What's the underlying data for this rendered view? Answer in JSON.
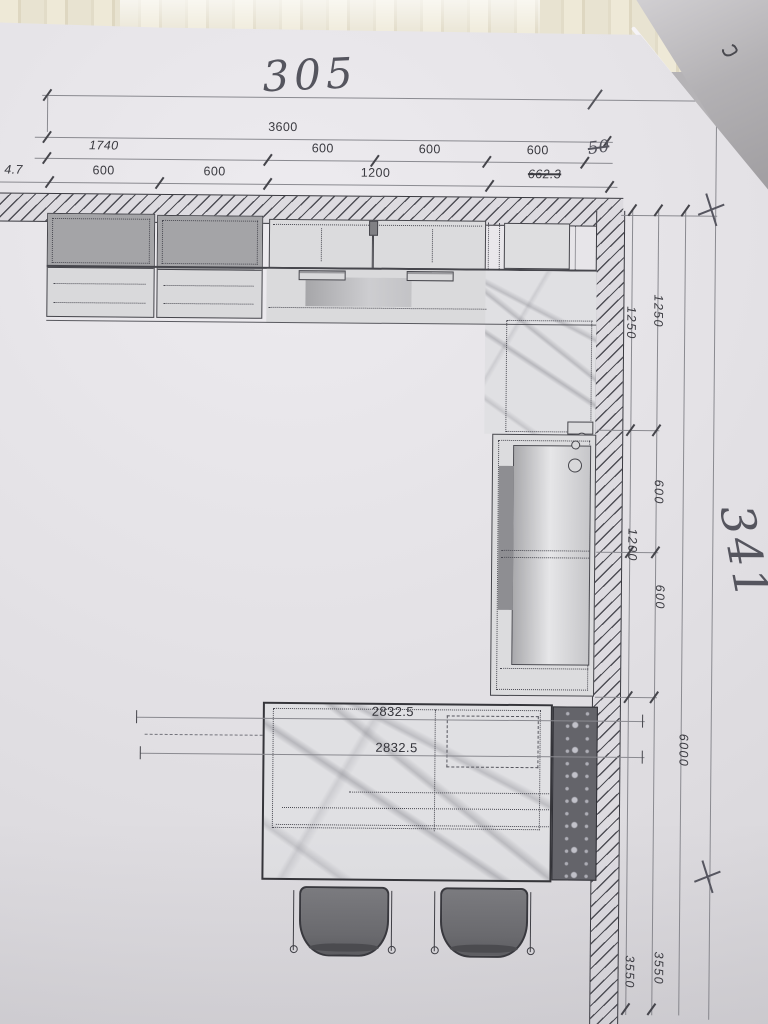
{
  "colors": {
    "paper": "#e3e1e5",
    "table_wood": "#e9e4d2",
    "table_gray": "#a8a6a9",
    "ink": "#3b3b41",
    "dim_line": "#8a8a90",
    "pencil": "#55555e",
    "cabinet_dark_fill": "#a4a4a7",
    "marble_base": "#e0e0e3",
    "radiator_dark": "#64646a",
    "stool_fill": "#6b6b6f"
  },
  "dims_top": {
    "overall_handwritten": "305",
    "line1_total": "3600",
    "line2": [
      "1740",
      "600",
      "600",
      "600",
      "50"
    ],
    "line3": [
      "4.7",
      "600",
      "600",
      "1200",
      "662.3"
    ]
  },
  "dims_right": {
    "overall_handwritten": "341",
    "inner_col": [
      "1250",
      "1200",
      "3550"
    ],
    "outer_col": [
      "1250",
      "600",
      "600",
      "3550"
    ],
    "total": "6000"
  },
  "island_dims": [
    "2832.5",
    "2832.5"
  ]
}
